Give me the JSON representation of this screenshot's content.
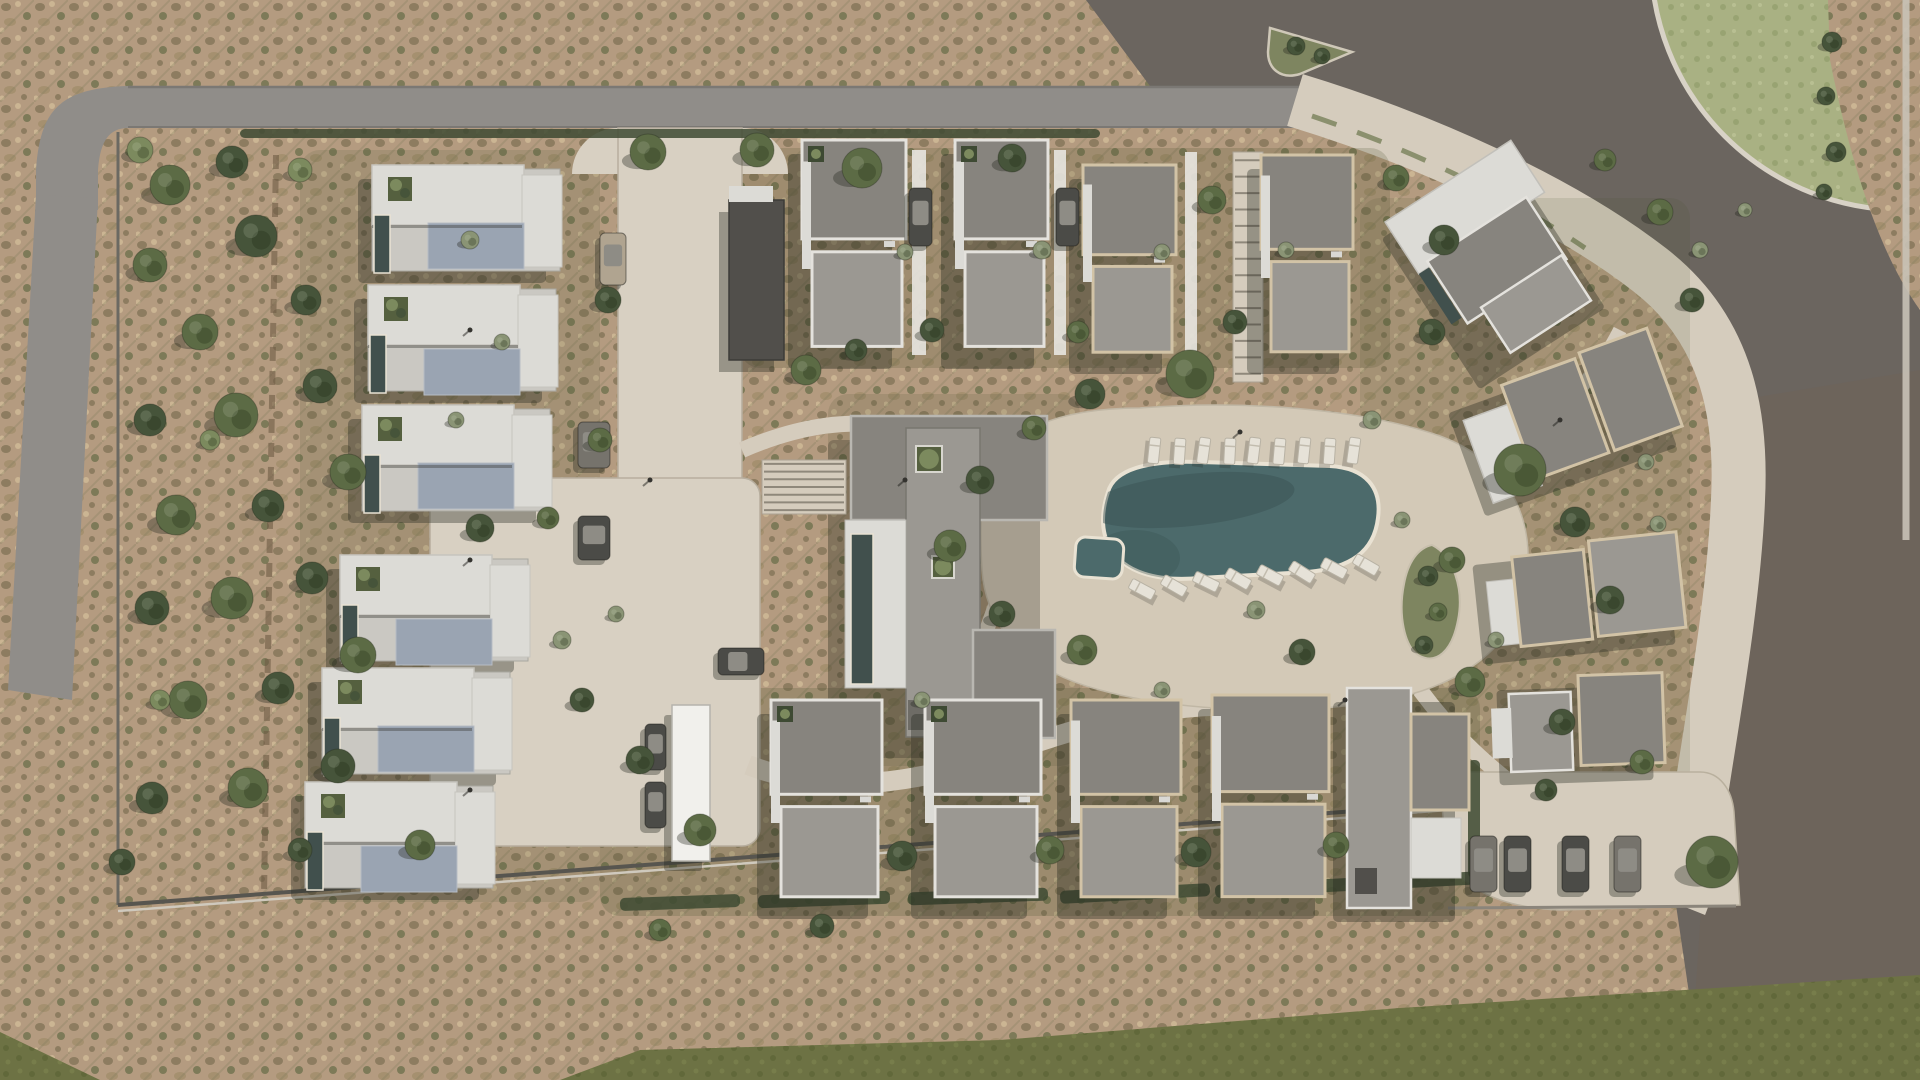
{
  "scene": {
    "label": "aerial-render-residential-masterplan",
    "palette": {
      "scrub_base": "#b49b80",
      "scrub_dot_dark": "#8d7c60",
      "scrub_dot_olive": "#7d7a58",
      "scrub_dot_light": "#cbb593",
      "scrub_dot_warm": "#a5906f",
      "road_gray": "#908d89",
      "road_edge": "#7b7874",
      "asphalt_dark": "#6b655f",
      "road_brown": "#6f6459",
      "path_beige": "#d5ccbd",
      "plaza_beige": "#d8d0c2",
      "deck_beige": "#d3c9b7",
      "path_edge": "#b7ae9e",
      "grass_olive": "#6d7244",
      "grass_dot": "#61683a",
      "lawn_green": "#a9b183",
      "lawn_dot": "#98a372",
      "island_green": "#7e8560",
      "water_teal": "#4c6a6b",
      "water_shadow": "#3a5254",
      "pool_coping": "#e9e2d3",
      "roof_dark": "#87847e",
      "roof_mid": "#9b9892",
      "roof_charcoal": "#514f4b",
      "trim_cream": "#d2c3a6",
      "trim_white": "#e4e2dd",
      "slab_white": "#dcdbd6",
      "slab_light": "#cac8c2",
      "roof_blue": "#9aa4b2",
      "lap_pool": "#41504d",
      "tree_green": "#5c6b45",
      "tree_dark": "#46543a",
      "tree_light": "#7c8a5e",
      "bush_gray": "#8a9475",
      "hedge_dark": "#3e4a33",
      "car_dark": "#4b4b47",
      "car_gray": "#76736c",
      "car_tan": "#b0a490",
      "car_roof": "#8e8c85",
      "shadow": "rgba(35,36,28,0.35)",
      "wood": "#6f5c45",
      "white_bldg": "#f1f0ec",
      "bed_dark": "#49522f"
    },
    "trees": [
      [
        170,
        185,
        20,
        "g"
      ],
      [
        232,
        162,
        16,
        "d"
      ],
      [
        150,
        265,
        17,
        "g"
      ],
      [
        256,
        236,
        21,
        "d"
      ],
      [
        200,
        332,
        18,
        "g"
      ],
      [
        306,
        300,
        15,
        "d"
      ],
      [
        150,
        420,
        16,
        "d"
      ],
      [
        236,
        415,
        22,
        "g"
      ],
      [
        320,
        386,
        17,
        "d"
      ],
      [
        176,
        515,
        20,
        "g"
      ],
      [
        268,
        506,
        16,
        "d"
      ],
      [
        348,
        472,
        18,
        "g"
      ],
      [
        152,
        608,
        17,
        "d"
      ],
      [
        232,
        598,
        21,
        "g"
      ],
      [
        312,
        578,
        16,
        "d"
      ],
      [
        188,
        700,
        19,
        "g"
      ],
      [
        278,
        688,
        16,
        "d"
      ],
      [
        358,
        655,
        18,
        "g"
      ],
      [
        152,
        798,
        16,
        "d"
      ],
      [
        248,
        788,
        20,
        "g"
      ],
      [
        338,
        766,
        17,
        "d"
      ],
      [
        420,
        845,
        15,
        "g"
      ],
      [
        122,
        862,
        13,
        "d"
      ],
      [
        140,
        150,
        13,
        "l"
      ],
      [
        300,
        170,
        12,
        "l"
      ],
      [
        210,
        440,
        10,
        "l"
      ],
      [
        160,
        700,
        10,
        "l"
      ],
      [
        300,
        850,
        12,
        "d"
      ],
      [
        648,
        152,
        18,
        "g"
      ],
      [
        757,
        150,
        17,
        "g"
      ],
      [
        608,
        300,
        13,
        "d"
      ],
      [
        600,
        440,
        12,
        "g"
      ],
      [
        480,
        528,
        14,
        "d"
      ],
      [
        548,
        518,
        11,
        "g"
      ],
      [
        862,
        168,
        20,
        "g"
      ],
      [
        1012,
        158,
        14,
        "d"
      ],
      [
        932,
        330,
        12,
        "d"
      ],
      [
        1078,
        332,
        11,
        "g"
      ],
      [
        1212,
        200,
        14,
        "g"
      ],
      [
        1235,
        322,
        12,
        "d"
      ],
      [
        1396,
        178,
        13,
        "g"
      ],
      [
        1444,
        240,
        15,
        "d"
      ],
      [
        1520,
        470,
        26,
        "g"
      ],
      [
        1575,
        522,
        15,
        "d"
      ],
      [
        1452,
        560,
        13,
        "g"
      ],
      [
        1610,
        600,
        14,
        "d"
      ],
      [
        1470,
        682,
        15,
        "g"
      ],
      [
        1562,
        722,
        13,
        "d"
      ],
      [
        1642,
        762,
        12,
        "g"
      ],
      [
        1692,
        300,
        12,
        "d"
      ],
      [
        1660,
        212,
        13,
        "g"
      ],
      [
        1432,
        332,
        13,
        "d"
      ],
      [
        1605,
        160,
        11,
        "g"
      ],
      [
        1190,
        374,
        24,
        "g"
      ],
      [
        1090,
        394,
        15,
        "d"
      ],
      [
        1034,
        428,
        12,
        "g"
      ],
      [
        980,
        480,
        14,
        "d"
      ],
      [
        950,
        546,
        16,
        "g"
      ],
      [
        1002,
        614,
        13,
        "d"
      ],
      [
        1082,
        650,
        15,
        "g"
      ],
      [
        1302,
        652,
        13,
        "d"
      ],
      [
        806,
        370,
        15,
        "g"
      ],
      [
        856,
        350,
        11,
        "d"
      ],
      [
        640,
        760,
        14,
        "d"
      ],
      [
        700,
        830,
        16,
        "g"
      ],
      [
        902,
        856,
        15,
        "d"
      ],
      [
        1050,
        850,
        14,
        "g"
      ],
      [
        1196,
        852,
        15,
        "d"
      ],
      [
        1336,
        845,
        13,
        "g"
      ],
      [
        582,
        700,
        12,
        "d"
      ],
      [
        660,
        930,
        11,
        "g"
      ],
      [
        822,
        926,
        12,
        "d"
      ],
      [
        1712,
        862,
        26,
        "g"
      ],
      [
        1546,
        790,
        11,
        "d"
      ],
      [
        1832,
        42,
        10,
        "d"
      ],
      [
        1826,
        96,
        9,
        "d"
      ],
      [
        1836,
        152,
        10,
        "d"
      ],
      [
        1824,
        192,
        8,
        "d"
      ],
      [
        1296,
        46,
        9,
        "d"
      ],
      [
        1322,
        56,
        8,
        "d"
      ],
      [
        1428,
        576,
        10,
        "d"
      ],
      [
        1438,
        612,
        9,
        "g"
      ],
      [
        1424,
        645,
        9,
        "d"
      ],
      [
        470,
        240,
        9,
        "b"
      ],
      [
        502,
        342,
        8,
        "b"
      ],
      [
        456,
        420,
        8,
        "b"
      ],
      [
        905,
        252,
        8,
        "b"
      ],
      [
        1042,
        250,
        9,
        "b"
      ],
      [
        1162,
        252,
        8,
        "b"
      ],
      [
        1286,
        250,
        8,
        "b"
      ],
      [
        562,
        640,
        9,
        "b"
      ],
      [
        616,
        614,
        8,
        "b"
      ],
      [
        1372,
        420,
        9,
        "b"
      ],
      [
        1402,
        520,
        8,
        "b"
      ],
      [
        1496,
        640,
        8,
        "b"
      ],
      [
        922,
        700,
        8,
        "b"
      ],
      [
        1256,
        610,
        9,
        "b"
      ],
      [
        1162,
        690,
        8,
        "b"
      ],
      [
        1646,
        462,
        8,
        "b"
      ],
      [
        1658,
        524,
        8,
        "b"
      ],
      [
        1700,
        250,
        8,
        "b"
      ],
      [
        1745,
        210,
        7,
        "b"
      ]
    ],
    "hedges": [
      [
        620,
        896,
        120,
        13,
        -2
      ],
      [
        758,
        893,
        132,
        13,
        -2
      ],
      [
        908,
        890,
        140,
        13,
        -2
      ],
      [
        1060,
        887,
        150,
        13,
        -3
      ],
      [
        1215,
        881,
        150,
        13,
        -3
      ],
      [
        1372,
        874,
        110,
        13,
        -3
      ],
      [
        240,
        129,
        860,
        9,
        0
      ],
      [
        1468,
        760,
        12,
        118,
        0
      ]
    ],
    "beds": [
      [
        740,
        148,
        650,
        220,
        0.2
      ],
      [
        600,
        688,
        880,
        228,
        0.22
      ],
      [
        828,
        394,
        252,
        372,
        0.16
      ],
      [
        1360,
        198,
        330,
        592,
        0.13
      ],
      [
        300,
        150,
        300,
        752,
        0.14
      ]
    ],
    "left_villas": [
      [
        372,
        165
      ],
      [
        368,
        285
      ],
      [
        362,
        405
      ],
      [
        340,
        555
      ],
      [
        322,
        668
      ],
      [
        305,
        782
      ]
    ],
    "houses_top": [
      [
        729,
        200,
        55,
        160,
        "charcoal"
      ],
      [
        802,
        140,
        104,
        215,
        "white"
      ],
      [
        955,
        140,
        93,
        215,
        "white"
      ],
      [
        1083,
        165,
        93,
        195,
        "cream"
      ],
      [
        1261,
        155,
        92,
        205,
        "cream"
      ]
    ],
    "houses_bottom": [
      [
        771,
        700,
        111,
        205,
        "white"
      ],
      [
        925,
        700,
        116,
        205,
        "white"
      ],
      [
        1071,
        700,
        110,
        205,
        "cream"
      ],
      [
        1212,
        695,
        117,
        210,
        "cream"
      ],
      [
        1347,
        688,
        122,
        220,
        "tall"
      ]
    ],
    "angled_villas": [
      [
        1385,
        222,
        -33,
        "A"
      ],
      [
        1455,
        398,
        -20,
        "B"
      ],
      [
        1483,
        552,
        -6,
        "C"
      ],
      [
        1508,
        678,
        -2,
        "D"
      ]
    ],
    "white_buildings": [
      [
        672,
        705,
        38,
        156
      ]
    ],
    "walls_light": [
      [
        912,
        150,
        14,
        205
      ],
      [
        1054,
        150,
        12,
        205
      ],
      [
        1185,
        152,
        12,
        200
      ]
    ],
    "planters": [
      [
        916,
        446,
        26
      ],
      [
        932,
        556,
        22
      ]
    ],
    "stairs": [
      {
        "x": 1233,
        "y": 152,
        "w": 30,
        "h": 230,
        "n": 14
      },
      {
        "x": 762,
        "y": 460,
        "w": 84,
        "h": 54,
        "n": 7
      }
    ],
    "loungers_top": [
      [
        1150,
        437,
        6
      ],
      [
        1175,
        438,
        4
      ],
      [
        1200,
        437,
        8
      ],
      [
        1225,
        438,
        3
      ],
      [
        1250,
        437,
        7
      ],
      [
        1275,
        438,
        5
      ],
      [
        1300,
        437,
        6
      ],
      [
        1325,
        438,
        4
      ],
      [
        1350,
        437,
        8
      ]
    ],
    "loungers_bottom": [
      [
        1128,
        588,
        -62
      ],
      [
        1160,
        584,
        -60
      ],
      [
        1192,
        581,
        -64
      ],
      [
        1224,
        577,
        -60
      ],
      [
        1256,
        574,
        -62
      ],
      [
        1288,
        570,
        -58
      ],
      [
        1320,
        567,
        -62
      ],
      [
        1352,
        563,
        -60
      ]
    ],
    "cars": [
      [
        600,
        233,
        26,
        52,
        0,
        "car_tan"
      ],
      [
        909,
        188,
        23,
        58,
        0,
        "car_dark"
      ],
      [
        1056,
        188,
        23,
        58,
        0,
        "car_dark"
      ],
      [
        578,
        422,
        32,
        46,
        0,
        "car_gray"
      ],
      [
        578,
        516,
        32,
        44,
        0,
        "car_dark"
      ],
      [
        645,
        724,
        21,
        46,
        0,
        "car_dark"
      ],
      [
        645,
        782,
        21,
        46,
        0,
        "car_dark"
      ],
      [
        718,
        648,
        46,
        27,
        0,
        "car_dark"
      ],
      [
        1470,
        836,
        27,
        56,
        0,
        "car_gray"
      ],
      [
        1504,
        836,
        27,
        56,
        0,
        "car_dark"
      ],
      [
        1562,
        836,
        27,
        56,
        0,
        "car_dark"
      ],
      [
        1614,
        836,
        27,
        56,
        0,
        "car_gray"
      ]
    ],
    "poles": [
      [
        470,
        330
      ],
      [
        470,
        560
      ],
      [
        470,
        790
      ],
      [
        650,
        480
      ],
      [
        1240,
        432
      ],
      [
        1345,
        700
      ],
      [
        1560,
        420
      ],
      [
        905,
        480
      ]
    ]
  }
}
